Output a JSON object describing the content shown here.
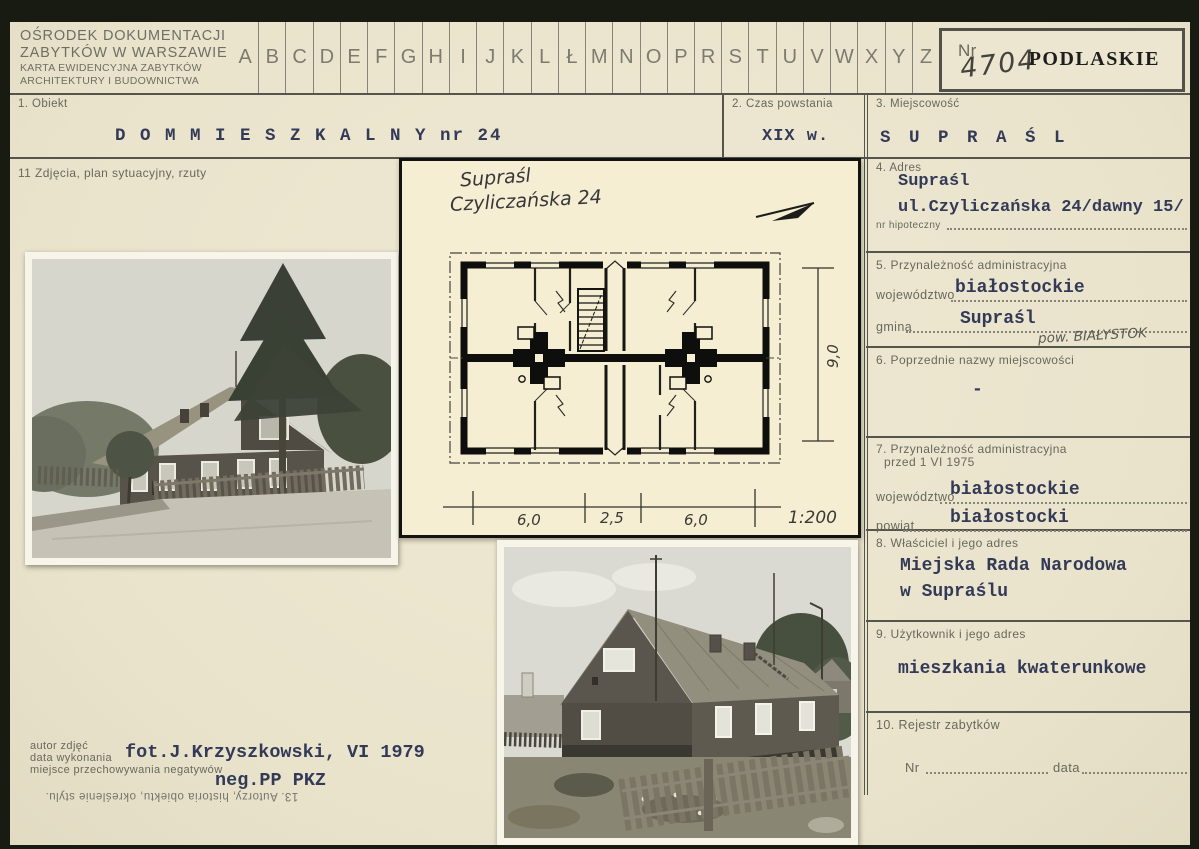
{
  "colors": {
    "paper": "#ebe5cf",
    "inset_paper": "#f5eed3",
    "print_ink": "#68685c",
    "typed_ink": "#333a57",
    "stamp_black": "#1d1d1d",
    "scan_background": "#181b11"
  },
  "header": {
    "org_lines": [
      "OŚRODEK DOKUMENTACJI",
      "ZABYTKÓW W WARSZAWIE",
      "KARTA EWIDENCYJNA ZABYTKÓW",
      "ARCHITEKTURY I BUDOWNICTWA"
    ],
    "alphabet": [
      "A",
      "B",
      "C",
      "D",
      "E",
      "F",
      "G",
      "H",
      "I",
      "J",
      "K",
      "L",
      "Ł",
      "M",
      "N",
      "O",
      "P",
      "R",
      "S",
      "T",
      "U",
      "V",
      "W",
      "X",
      "Y",
      "Z"
    ],
    "nr_label": "Nr",
    "nr_value": "4704",
    "voivodeship_stamp": "PODLASKIE"
  },
  "fields": {
    "s1": {
      "label": "1. Obiekt",
      "value": "D O M  M I E S Z K A L N Y  nr 24"
    },
    "s2": {
      "label": "2. Czas powstania",
      "value": "XIX w."
    },
    "s3": {
      "label": "3. Miejscowość",
      "value": "S U P R A Ś L"
    },
    "s4": {
      "label": "4. Adres",
      "line1": "Supraśl",
      "line2": "ul.Czyliczańska 24/dawny 15/",
      "sublabel": "nr hipoteczny"
    },
    "s5": {
      "label": "5. Przynależność administracyjna",
      "f1_label": "województwo",
      "f1_value": "białostockie",
      "f2_label": "gmina",
      "f2_value": "Supraśl",
      "handwritten": "pow. BIAŁYSTOK"
    },
    "s6": {
      "label": "6. Poprzednie nazwy miejscowości",
      "value": "-"
    },
    "s7": {
      "label": "7. Przynależność administracyjna",
      "label2": "przed 1 VI 1975",
      "f1_label": "województwo",
      "f1_value": "białostockie",
      "f2_label": "powiat",
      "f2_value": "białostocki"
    },
    "s8": {
      "label": "8. Właściciel i jego adres",
      "line1": "Miejska Rada Narodowa",
      "line2": "w Supraślu"
    },
    "s9": {
      "label": "9. Użytkownik i jego adres",
      "value": "mieszkania kwaterunkowe"
    },
    "s10": {
      "label": "10. Rejestr zabytków",
      "nr_label": "Nr",
      "date_label": "data"
    },
    "s11": {
      "label": "11 Zdjęcia, plan sytuacyjny, rzuty"
    },
    "s13": {
      "label": "13. Autorzy, historia obiektu, określenie stylu."
    }
  },
  "plan": {
    "handwritten_line1": "Supraśl",
    "handwritten_line2": "Czyliczańska 24",
    "dim_left": "6,0",
    "dim_mid": "2,5",
    "dim_right": "6,0",
    "dim_height": "9,0",
    "scale": "1:200"
  },
  "footer": {
    "author_label": "autor zdjęć",
    "date_label": "data wykonania",
    "neg_label": "miejsce przechowywania negatywów",
    "author_value": "fot.J.Krzyszkowski, VI 1979",
    "neg_value": "neg.PP PKZ"
  }
}
